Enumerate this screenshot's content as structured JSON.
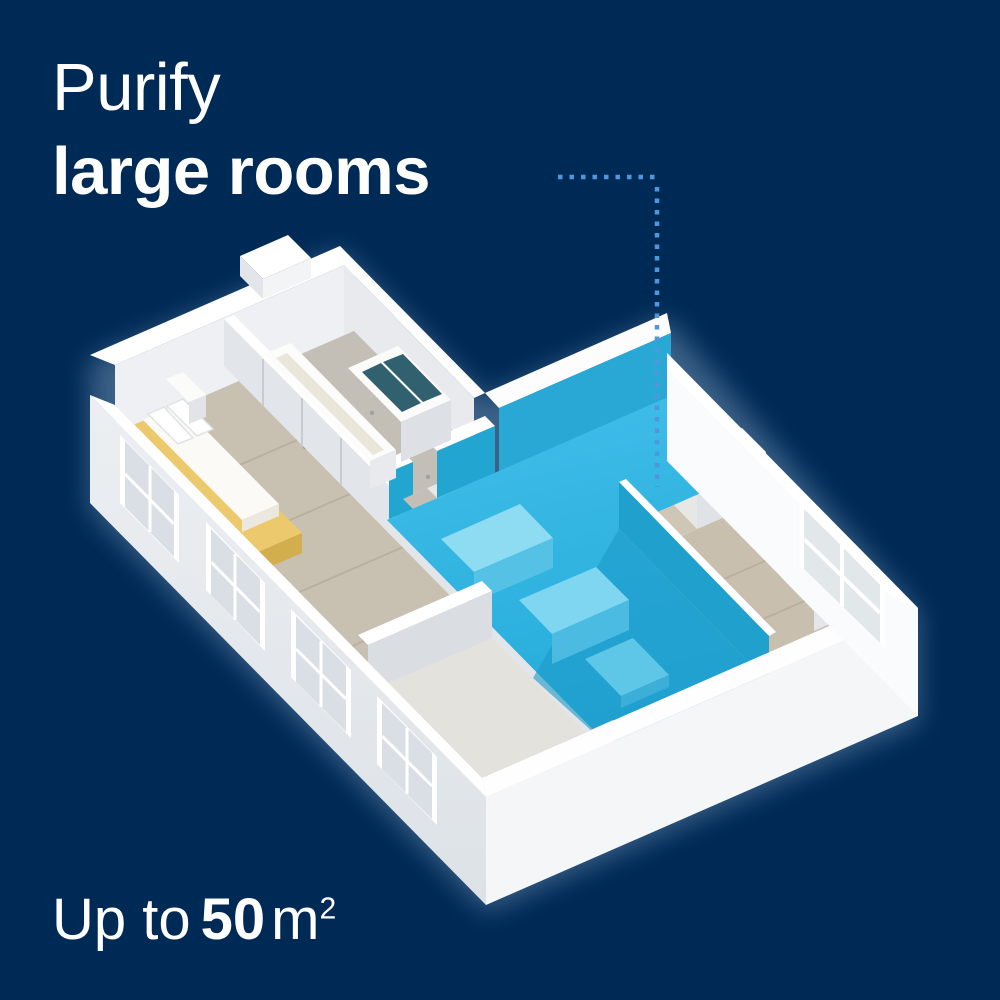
{
  "headline": {
    "line1": "Purify",
    "line2": "large rooms"
  },
  "area_caption": {
    "prefix": "Up to",
    "value": "50",
    "unit": "m",
    "unit_superscript": "2"
  },
  "colors": {
    "background": "#002a56",
    "highlight_blue": "#2fb4e2",
    "highlight_blue_dark": "#1b9cca",
    "dotted_line": "#4f96dc",
    "text": "#ffffff",
    "wall_white": "#ffffff",
    "bed_frame_yellow": "#ecc96c"
  }
}
